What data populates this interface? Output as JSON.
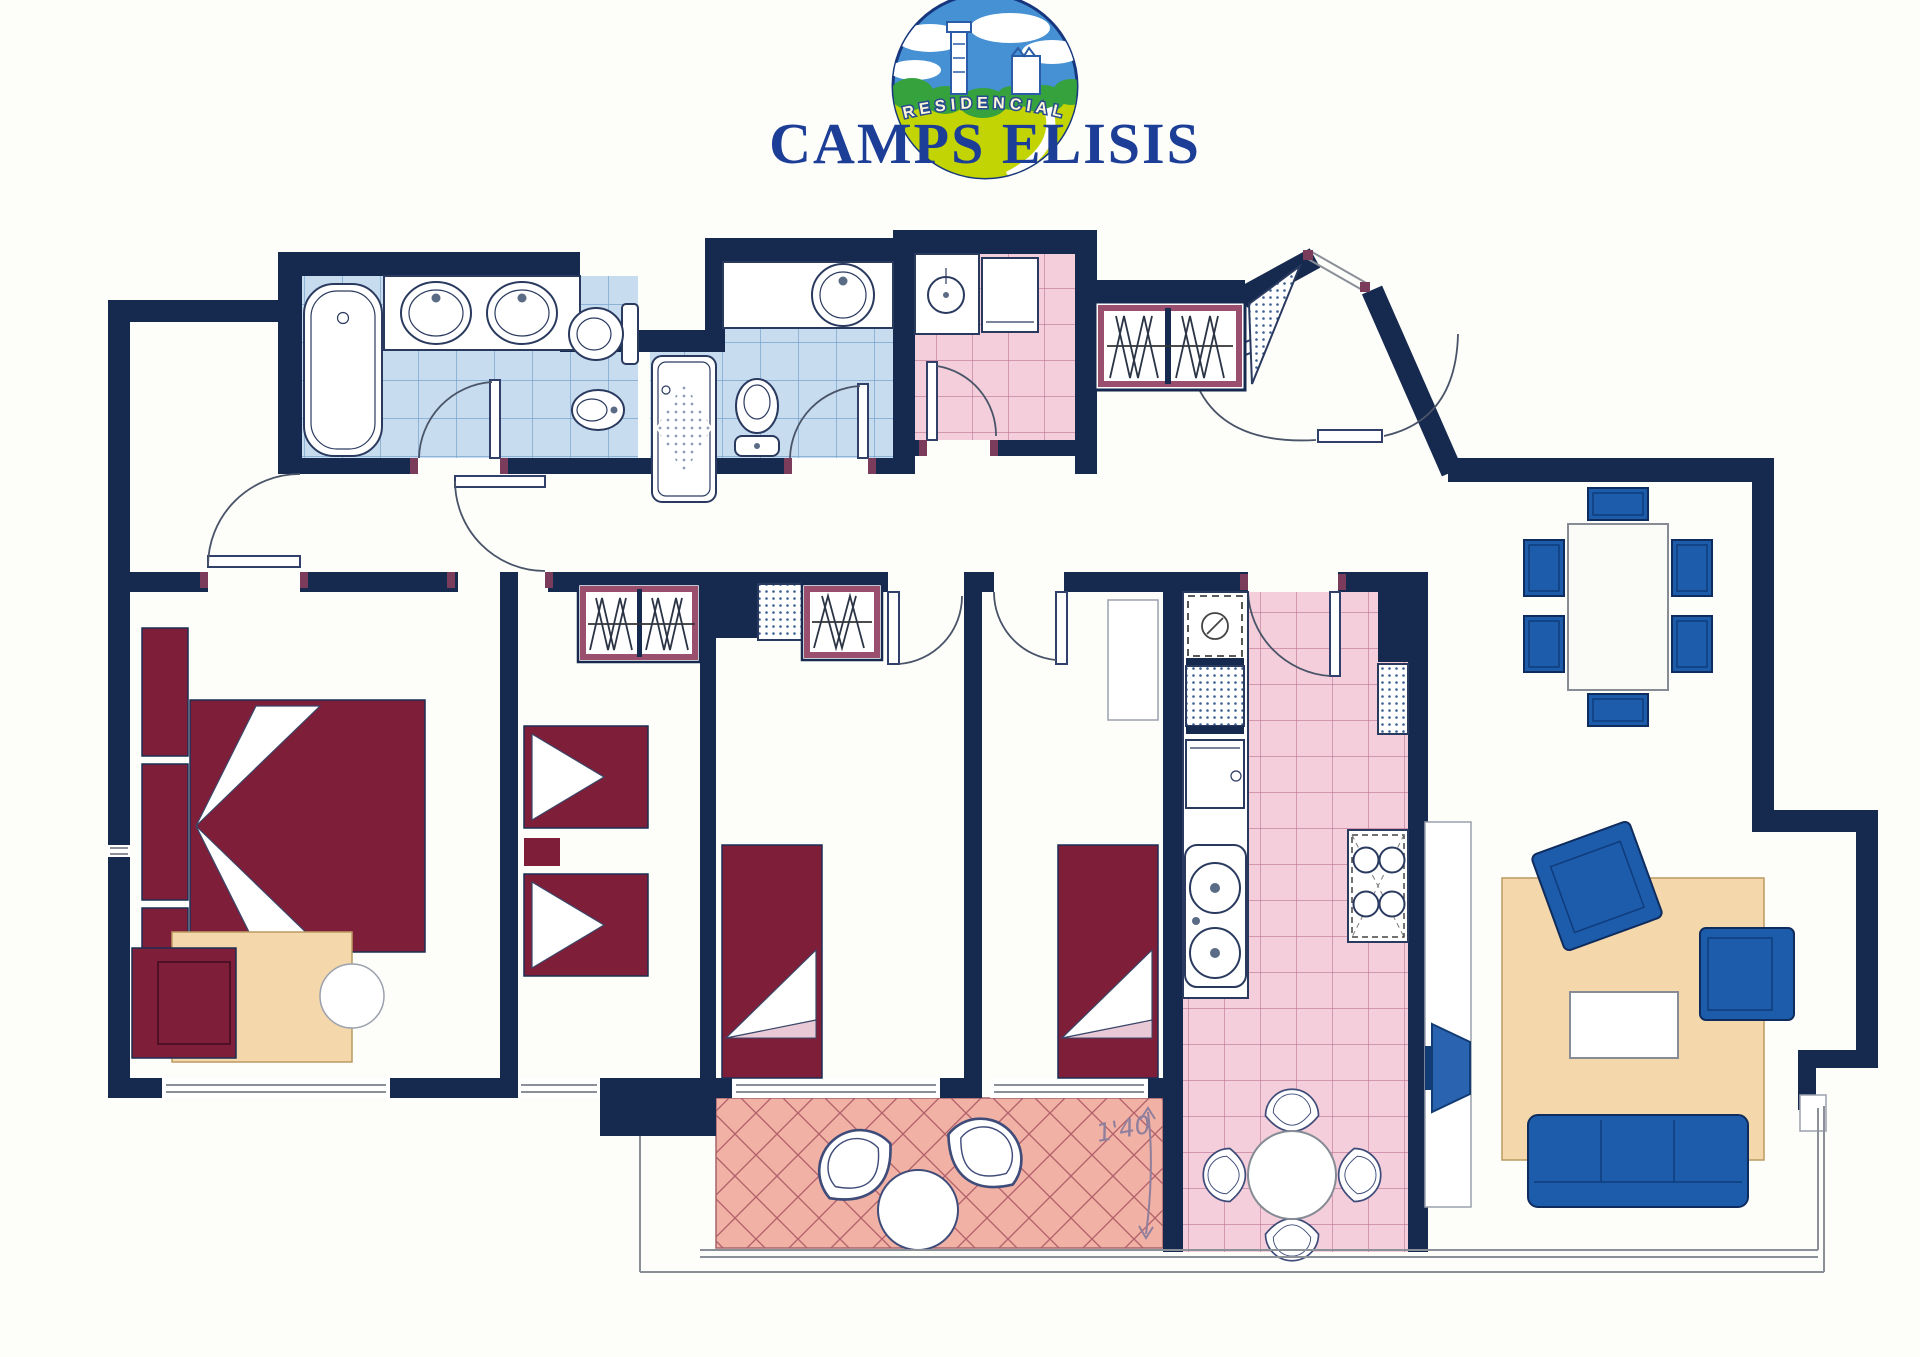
{
  "logo": {
    "subtitle": "RESIDENCIAL",
    "title": "CAMPS ELISIS"
  },
  "annotations": {
    "terrace_note": "1'40"
  },
  "colors": {
    "c-wall": "#16294e",
    "c-blue-tile": "#c7dcee",
    "c-blue-tile-line": "#78a4cd",
    "c-pink-tile": "#f4cfdb",
    "c-pink-tile-line": "#bd7493",
    "c-terrace-tile": "#f1b2a5",
    "c-terrace-tile-line": "#b2606a",
    "c-bed": "#7e1e39",
    "c-furniture-blue": "#1d5cab",
    "c-rug": "#f4d8ab",
    "c-logo-blue": "#1c3e97",
    "c-logo-green": "#36a23e",
    "c-logo-yellow": "#c3d404",
    "c-logo-sky": "#4690d4"
  }
}
